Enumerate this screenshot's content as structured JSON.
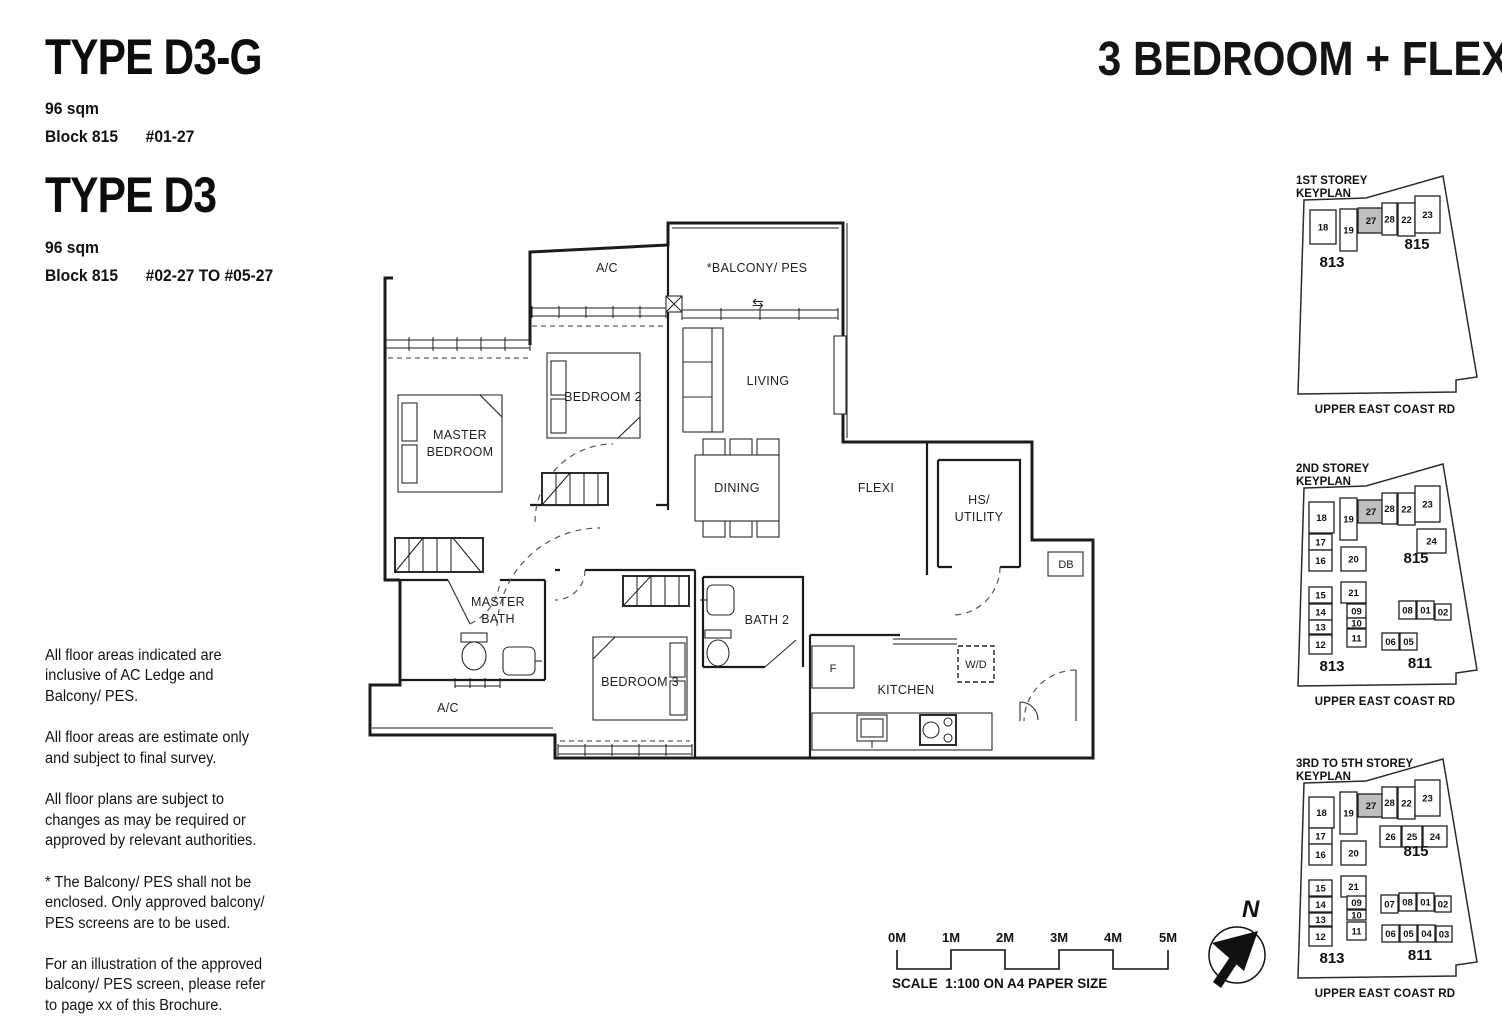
{
  "header": {
    "type1": {
      "name": "TYPE D3-G",
      "area": "96 sqm",
      "block": "Block 815",
      "stack": "#01-27"
    },
    "type2": {
      "name": "TYPE D3",
      "area": "96 sqm",
      "block": "Block 815",
      "stack": "#02-27 TO #05-27"
    },
    "category": "3 BEDROOM + FLEXI"
  },
  "notes": [
    "All floor areas indicated are inclusive of AC Ledge and Balcony/ PES.",
    "All floor areas are estimate only and subject to final survey.",
    "All floor plans are subject to changes as may be required or approved by relevant authorities.",
    "* The Balcony/ PES shall not be enclosed. Only approved balcony/ PES screens are to be used.",
    "For an illustration of the approved balcony/ PES screen, please refer to page xx of this Brochure."
  ],
  "floorplan": {
    "labels": {
      "ac_top": "A/C",
      "balcony": "*BALCONY/ PES",
      "balcony_arrow": "⇆",
      "bedroom2": "BEDROOM 2",
      "living": "LIVING",
      "master_line1": "MASTER",
      "master_line2": "BEDROOM",
      "dining": "DINING",
      "flexi": "FLEXI",
      "hs_line1": "HS/",
      "hs_line2": "UTILITY",
      "db": "DB",
      "mbath_line1": "MASTER",
      "mbath_line2": "BATH",
      "bath2": "BATH 2",
      "bedroom3": "BEDROOM 3",
      "ac_bottom": "A/C",
      "fridge": "F",
      "kitchen": "KITCHEN",
      "wd": "W/D"
    }
  },
  "keyplans": [
    {
      "title1": "1ST STOREY",
      "title2": "KEYPLAN",
      "road": "UPPER EAST COAST RD",
      "units": [
        {
          "n": "18",
          "x": 22,
          "y": 38,
          "w": 26,
          "h": 34
        },
        {
          "n": "19",
          "x": 52,
          "y": 37,
          "w": 17,
          "h": 42
        },
        {
          "n": "27",
          "x": 70,
          "y": 36,
          "w": 26,
          "h": 25,
          "hl": true
        },
        {
          "n": "28",
          "x": 94,
          "y": 31,
          "w": 15,
          "h": 32
        },
        {
          "n": "22",
          "x": 110,
          "y": 31,
          "w": 17,
          "h": 33
        },
        {
          "n": "23",
          "x": 127,
          "y": 24,
          "w": 25,
          "h": 37
        }
      ],
      "blocks": [
        {
          "n": "815",
          "x": 129,
          "y": 77
        },
        {
          "n": "813",
          "x": 44,
          "y": 95
        }
      ]
    },
    {
      "title1": "2ND STOREY",
      "title2": "KEYPLAN",
      "road": "UPPER EAST COAST RD",
      "units": [
        {
          "n": "18",
          "x": 21,
          "y": 42,
          "w": 25,
          "h": 31
        },
        {
          "n": "19",
          "x": 52,
          "y": 38,
          "w": 17,
          "h": 42
        },
        {
          "n": "27",
          "x": 70,
          "y": 40,
          "w": 26,
          "h": 23,
          "hl": true
        },
        {
          "n": "28",
          "x": 94,
          "y": 33,
          "w": 15,
          "h": 31
        },
        {
          "n": "22",
          "x": 110,
          "y": 33,
          "w": 17,
          "h": 32
        },
        {
          "n": "23",
          "x": 127,
          "y": 26,
          "w": 25,
          "h": 36
        },
        {
          "n": "17",
          "x": 21,
          "y": 74,
          "w": 23,
          "h": 16
        },
        {
          "n": "24",
          "x": 129,
          "y": 69,
          "w": 29,
          "h": 24
        },
        {
          "n": "16",
          "x": 21,
          "y": 90,
          "w": 23,
          "h": 21
        },
        {
          "n": "20",
          "x": 53,
          "y": 87,
          "w": 25,
          "h": 24
        },
        {
          "n": "15",
          "x": 21,
          "y": 127,
          "w": 23,
          "h": 16
        },
        {
          "n": "21",
          "x": 53,
          "y": 122,
          "w": 25,
          "h": 21
        },
        {
          "n": "14",
          "x": 21,
          "y": 144,
          "w": 23,
          "h": 16
        },
        {
          "n": "09",
          "x": 59,
          "y": 144,
          "w": 19,
          "h": 14
        },
        {
          "n": "10",
          "x": 59,
          "y": 158,
          "w": 19,
          "h": 10
        },
        {
          "n": "13",
          "x": 21,
          "y": 160,
          "w": 23,
          "h": 14
        },
        {
          "n": "12",
          "x": 21,
          "y": 175,
          "w": 23,
          "h": 19
        },
        {
          "n": "11",
          "x": 59,
          "y": 169,
          "w": 19,
          "h": 18
        },
        {
          "n": "08",
          "x": 111,
          "y": 141,
          "w": 17,
          "h": 18
        },
        {
          "n": "01",
          "x": 129,
          "y": 141,
          "w": 17,
          "h": 18
        },
        {
          "n": "02",
          "x": 147,
          "y": 144,
          "w": 16,
          "h": 16
        },
        {
          "n": "06",
          "x": 94,
          "y": 173,
          "w": 17,
          "h": 17
        },
        {
          "n": "05",
          "x": 112,
          "y": 173,
          "w": 17,
          "h": 17
        }
      ],
      "blocks": [
        {
          "n": "815",
          "x": 128,
          "y": 103
        },
        {
          "n": "813",
          "x": 44,
          "y": 211
        },
        {
          "n": "811",
          "x": 132,
          "y": 208
        }
      ]
    },
    {
      "title1": "3RD TO 5TH STOREY",
      "title2": "KEYPLAN",
      "road": "UPPER EAST COAST RD",
      "units": [
        {
          "n": "18",
          "x": 21,
          "y": 42,
          "w": 25,
          "h": 31
        },
        {
          "n": "19",
          "x": 52,
          "y": 37,
          "w": 17,
          "h": 42
        },
        {
          "n": "27",
          "x": 70,
          "y": 39,
          "w": 26,
          "h": 23,
          "hl": true
        },
        {
          "n": "28",
          "x": 94,
          "y": 32,
          "w": 15,
          "h": 31
        },
        {
          "n": "22",
          "x": 110,
          "y": 32,
          "w": 17,
          "h": 32
        },
        {
          "n": "23",
          "x": 127,
          "y": 25,
          "w": 25,
          "h": 36
        },
        {
          "n": "17",
          "x": 21,
          "y": 73,
          "w": 23,
          "h": 16
        },
        {
          "n": "26",
          "x": 92,
          "y": 71,
          "w": 21,
          "h": 21
        },
        {
          "n": "25",
          "x": 114,
          "y": 71,
          "w": 20,
          "h": 21
        },
        {
          "n": "24",
          "x": 135,
          "y": 71,
          "w": 24,
          "h": 21
        },
        {
          "n": "16",
          "x": 21,
          "y": 89,
          "w": 23,
          "h": 21
        },
        {
          "n": "20",
          "x": 53,
          "y": 86,
          "w": 25,
          "h": 24
        },
        {
          "n": "15",
          "x": 21,
          "y": 125,
          "w": 23,
          "h": 16
        },
        {
          "n": "21",
          "x": 53,
          "y": 121,
          "w": 25,
          "h": 21
        },
        {
          "n": "14",
          "x": 21,
          "y": 142,
          "w": 23,
          "h": 15
        },
        {
          "n": "09",
          "x": 59,
          "y": 141,
          "w": 19,
          "h": 13
        },
        {
          "n": "07",
          "x": 93,
          "y": 140,
          "w": 17,
          "h": 18
        },
        {
          "n": "08",
          "x": 111,
          "y": 138,
          "w": 17,
          "h": 18
        },
        {
          "n": "01",
          "x": 129,
          "y": 138,
          "w": 17,
          "h": 18
        },
        {
          "n": "02",
          "x": 147,
          "y": 141,
          "w": 16,
          "h": 16
        },
        {
          "n": "13",
          "x": 21,
          "y": 158,
          "w": 23,
          "h": 13
        },
        {
          "n": "10",
          "x": 59,
          "y": 155,
          "w": 19,
          "h": 10
        },
        {
          "n": "12",
          "x": 21,
          "y": 172,
          "w": 23,
          "h": 19
        },
        {
          "n": "11",
          "x": 59,
          "y": 167,
          "w": 19,
          "h": 18
        },
        {
          "n": "06",
          "x": 94,
          "y": 170,
          "w": 17,
          "h": 17
        },
        {
          "n": "05",
          "x": 112,
          "y": 170,
          "w": 17,
          "h": 17
        },
        {
          "n": "04",
          "x": 130,
          "y": 170,
          "w": 17,
          "h": 17
        },
        {
          "n": "03",
          "x": 148,
          "y": 171,
          "w": 16,
          "h": 16
        }
      ],
      "blocks": [
        {
          "n": "815",
          "x": 128,
          "y": 101
        },
        {
          "n": "813",
          "x": 44,
          "y": 208
        },
        {
          "n": "811",
          "x": 132,
          "y": 205
        }
      ]
    }
  ],
  "scalebar": {
    "ticks": [
      "0M",
      "1M",
      "2M",
      "3M",
      "4M",
      "5M"
    ],
    "caption": "SCALE  1:100 ON A4 PAPER SIZE"
  },
  "compass": {
    "label": "N"
  }
}
